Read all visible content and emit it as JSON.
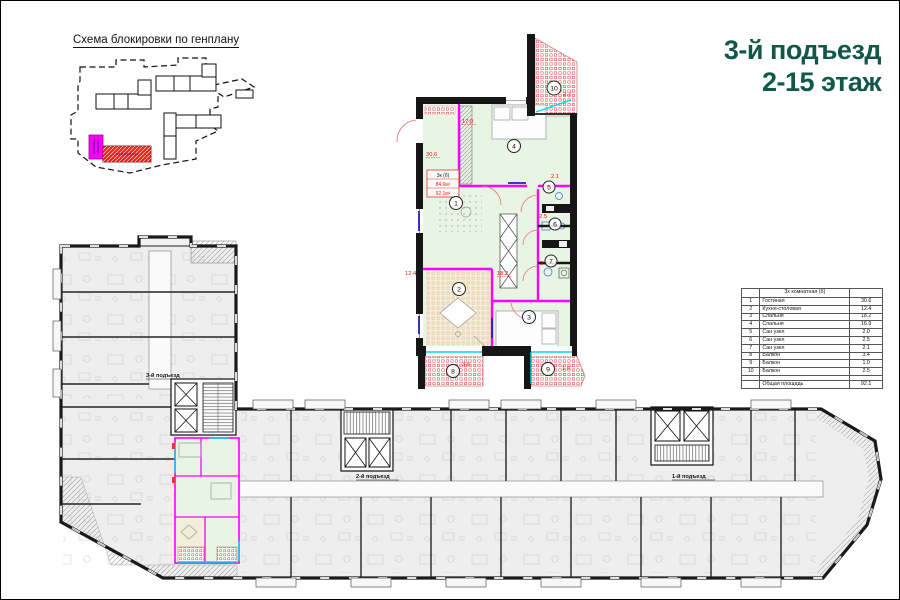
{
  "page": {
    "background": "#ffffff",
    "border_color": "#000000"
  },
  "genplan": {
    "title": "Схема блокировки по генплану",
    "highlight_colors": {
      "entrance_block": "#ff00ff",
      "building_block": "#fb1714"
    }
  },
  "header": {
    "line1": "3-й подъезд",
    "line2": "2-15 этаж",
    "color": "#11584a"
  },
  "apartment_plan": {
    "stamp": {
      "type_label": "3к (б)",
      "living_area": "84.6м²",
      "total_area": "92.1м²"
    },
    "rooms": [
      {
        "num": "1",
        "area": "30.6"
      },
      {
        "num": "2",
        "area": "12.4"
      },
      {
        "num": "3",
        "area": "18.2"
      },
      {
        "num": "4",
        "area": "17.0"
      },
      {
        "num": "5",
        "area": "2.1"
      },
      {
        "num": "6",
        "area": "2.5"
      },
      {
        "num": "7",
        "area": "2.0"
      },
      {
        "num": "8",
        "area": "3.6"
      },
      {
        "num": "9",
        "area": "1.0"
      },
      {
        "num": "10",
        "area": "2.7"
      }
    ],
    "colors": {
      "room_fill": "#e8f4e4",
      "kitchen_fill": "#f2eed8",
      "partition": "#ff00ff",
      "glazing": "#00d4e8",
      "dimension_text": "#e8190f"
    }
  },
  "area_table": {
    "col_header": "3х комнатная (б)",
    "rows": [
      {
        "num": "1",
        "name": "Гостиная",
        "area": "30.6"
      },
      {
        "num": "2",
        "name": "Кухня-столовая",
        "area": "12.4"
      },
      {
        "num": "3",
        "name": "Спальня",
        "area": "18.2"
      },
      {
        "num": "4",
        "name": "Спальня",
        "area": "16.9"
      },
      {
        "num": "5",
        "name": "Сан узел",
        "area": "2.0"
      },
      {
        "num": "6",
        "name": "Сан узел",
        "area": "2.5"
      },
      {
        "num": "7",
        "name": "Сан узел",
        "area": "2.1"
      },
      {
        "num": "8",
        "name": "Балкон",
        "area": "3.4"
      },
      {
        "num": "9",
        "name": "Балкон",
        "area": "1.0"
      },
      {
        "num": "10",
        "name": "Балкон",
        "area": "2.5"
      }
    ],
    "total_label": "Общая площадь",
    "total_value": "92.1"
  },
  "floor_plan": {
    "entrances": [
      {
        "label": "3-й подъезд"
      },
      {
        "label": "2-й подъезд"
      },
      {
        "label": "1-й подъезд"
      }
    ]
  }
}
